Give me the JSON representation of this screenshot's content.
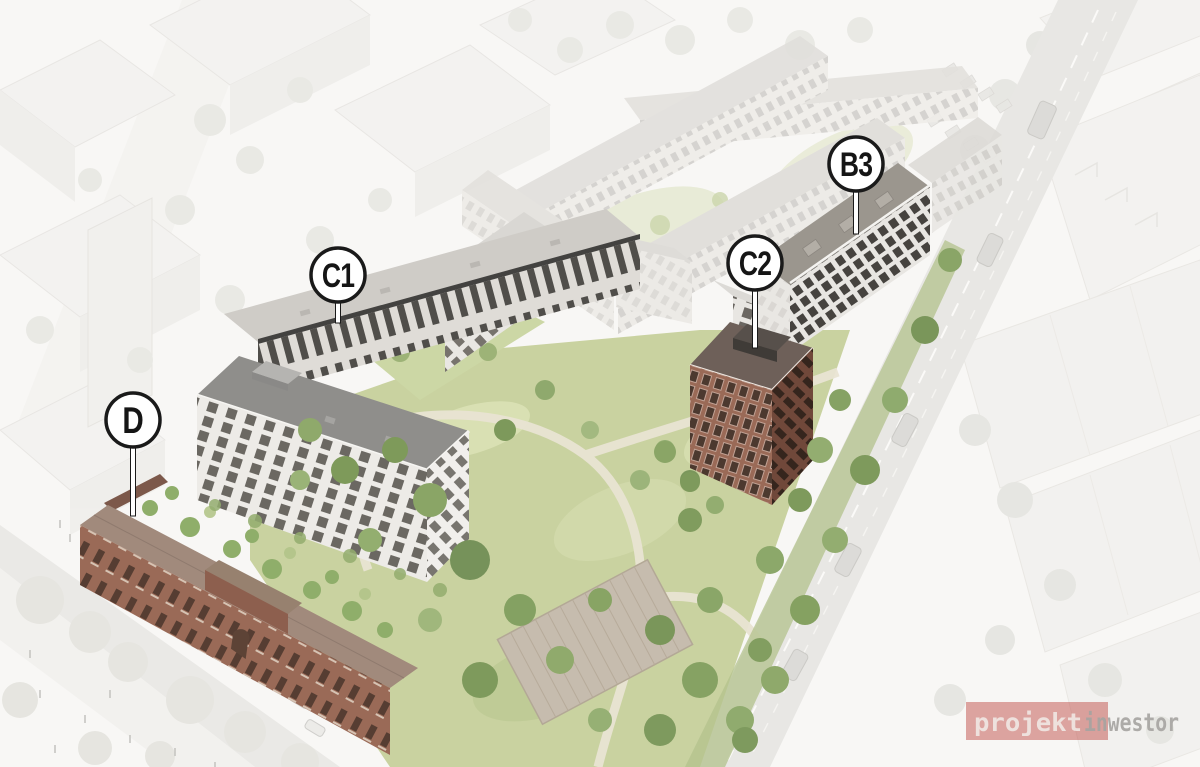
{
  "markers": [
    {
      "label": "D"
    },
    {
      "label": "C1"
    },
    {
      "label": "C2"
    },
    {
      "label": "B3"
    }
  ],
  "watermark": {
    "part1": "projekt",
    "part2": "inwestor"
  },
  "colors": {
    "pin_fill": "#ffffff",
    "pin_stroke": "#1a1a1a",
    "pin_text": "#151515",
    "watermark_red": "#c0504a",
    "watermark_text_light": "#f2ece8",
    "watermark_text_gray": "#a6a4a1",
    "park_green": "#c9d2a0",
    "brick_facade": "#9a6a57",
    "dark_brick_facade": "#70483a",
    "white_facade": "#edebe7",
    "dark_roof": "#6e6059"
  }
}
